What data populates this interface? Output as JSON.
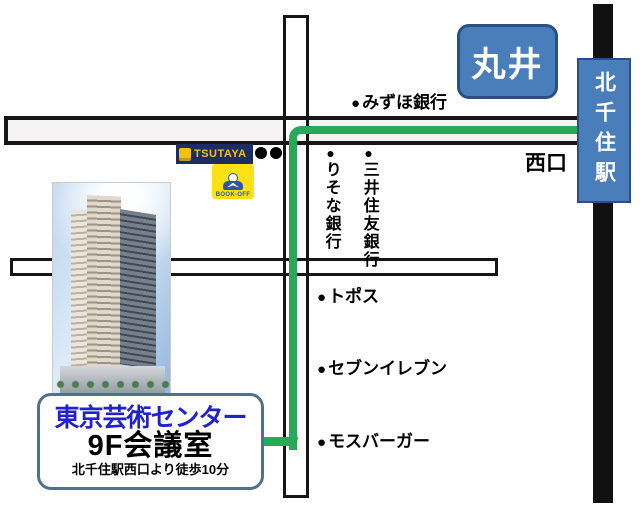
{
  "map": {
    "colors": {
      "route_green": "#2aa85a",
      "box_blue_fill": "#4a7ebb",
      "box_blue_border": "#2b4f80",
      "title_blue_text": "#2222cc",
      "info_box_border": "#51708f",
      "tsutaya_navy": "#1b2d63",
      "tsutaya_yellow": "#f2c10f",
      "bookoff_yellow": "#ffe012",
      "bookoff_blue": "#2c57a5"
    },
    "marui": {
      "label": "丸井"
    },
    "station": {
      "name": "北千住駅",
      "exit_label": "西口"
    },
    "landmarks": {
      "mizuho": {
        "bullet": "●",
        "label": "みずほ銀行"
      },
      "risona": {
        "bullet": "●",
        "label": "りそな銀行"
      },
      "smbc": {
        "bullet": "●",
        "label": "三井住友銀行"
      },
      "topos": {
        "bullet": "●",
        "label": "トポス"
      },
      "seven_eleven": {
        "bullet": "●",
        "label": "セブンイレブン"
      },
      "mos_burger": {
        "bullet": "●",
        "label": "モスバーガー"
      }
    },
    "shops": {
      "tsutaya": {
        "label": "TSUTAYA"
      },
      "bookoff": {
        "label": "BOOK-OFF"
      }
    },
    "info_box": {
      "name": "東京芸術センター",
      "room": "9F会議室",
      "walk_note": "北千住駅西口より徒歩10分"
    }
  }
}
